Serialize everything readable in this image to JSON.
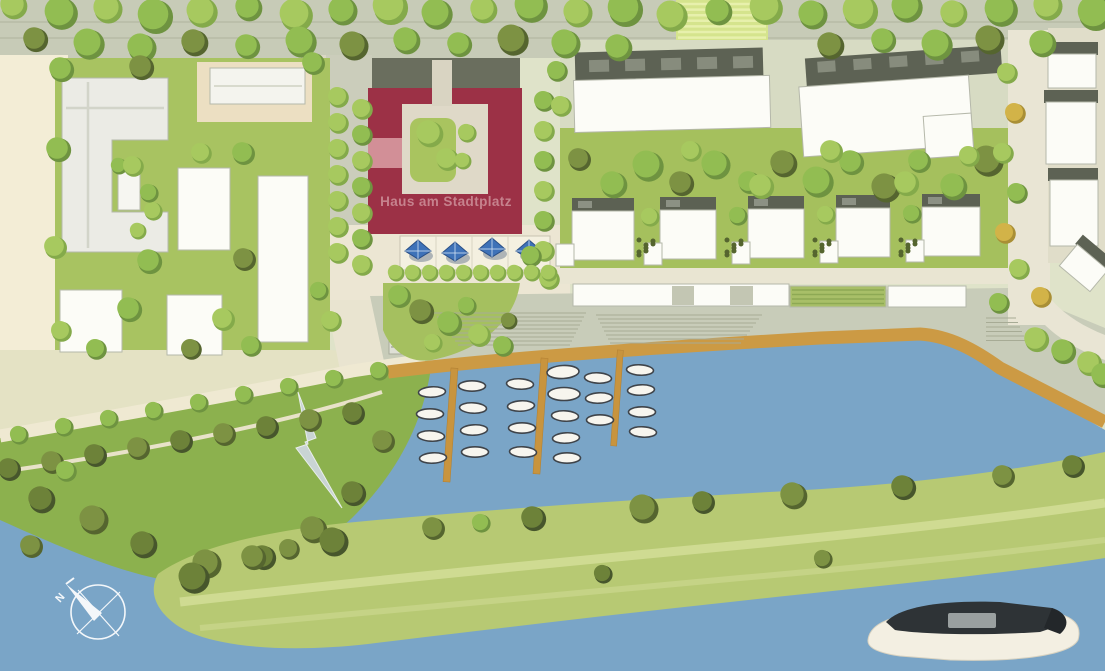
{
  "plan": {
    "labels": {
      "featured_building": "Haus am Stadtplatz",
      "compass_north": "N"
    },
    "marina": {
      "pier_count": 3,
      "boat_count": 24
    },
    "plaza": {
      "umbrella_count": 4
    },
    "colors": {
      "water": "#7aa5c7",
      "grass": "#a8c361",
      "bank_green": "#8cb14e",
      "peninsula_green": "#b7c973",
      "featured_building_red": "#9c3146",
      "featured_label_pink": "#c6828d",
      "boardwalk_orange": "#cc9a44",
      "pier_wood": "#c8943e",
      "roof_dark_gray": "#5d6254",
      "building_white": "#fcfcf7",
      "plaza_cream": "#ece6d3",
      "promenade_gray": "#c8ccb9",
      "umbrella_blue": "#3e72b8",
      "ship_deck_dark": "#2e3336"
    }
  }
}
